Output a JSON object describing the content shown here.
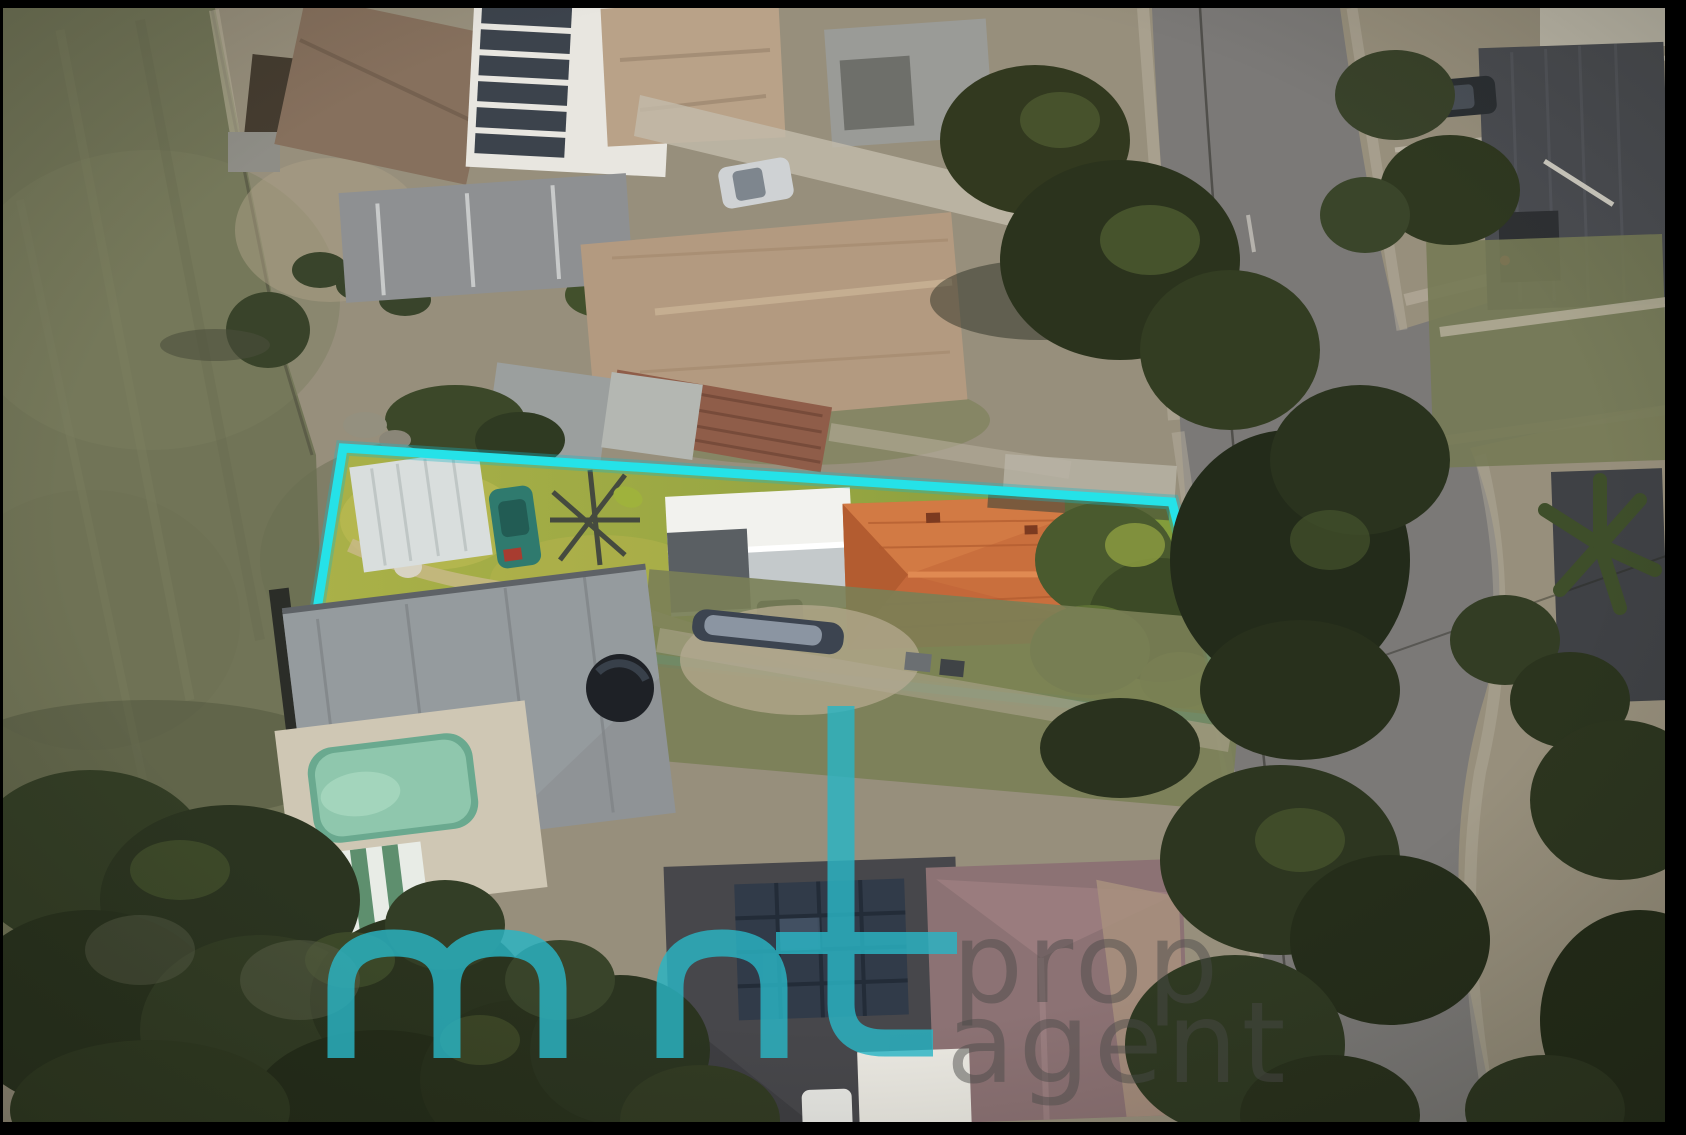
{
  "image": {
    "kind": "aerial-drone-photograph",
    "subject": "long narrow residential lot highlighted with a boundary outline, surrounded by houses, a grass reserve, roads and trees"
  },
  "annotation": {
    "boundary_color": "#25e2e8",
    "boundary_glow_color": "#18b8c6",
    "boundary_shape": "quadrilateral"
  },
  "watermark": {
    "brand_teal_text": "m nt",
    "caption_line_1": "prop",
    "caption_line_2": "agent",
    "teal_color": "#2ab5c5",
    "grey_color": "#4a4a48"
  },
  "palette": {
    "frame_black": "#000000",
    "field_green": "#717457",
    "ground_tan": "#978f7c",
    "road_grey": "#7b7977",
    "lot_lawn_bright": "#a9b24a",
    "orange_roof": "#c96f3d",
    "white_garage_roof": "#eef0ec",
    "grey_neighbour_roof": "#8f9396",
    "pool_water": "#8fc7ad"
  }
}
